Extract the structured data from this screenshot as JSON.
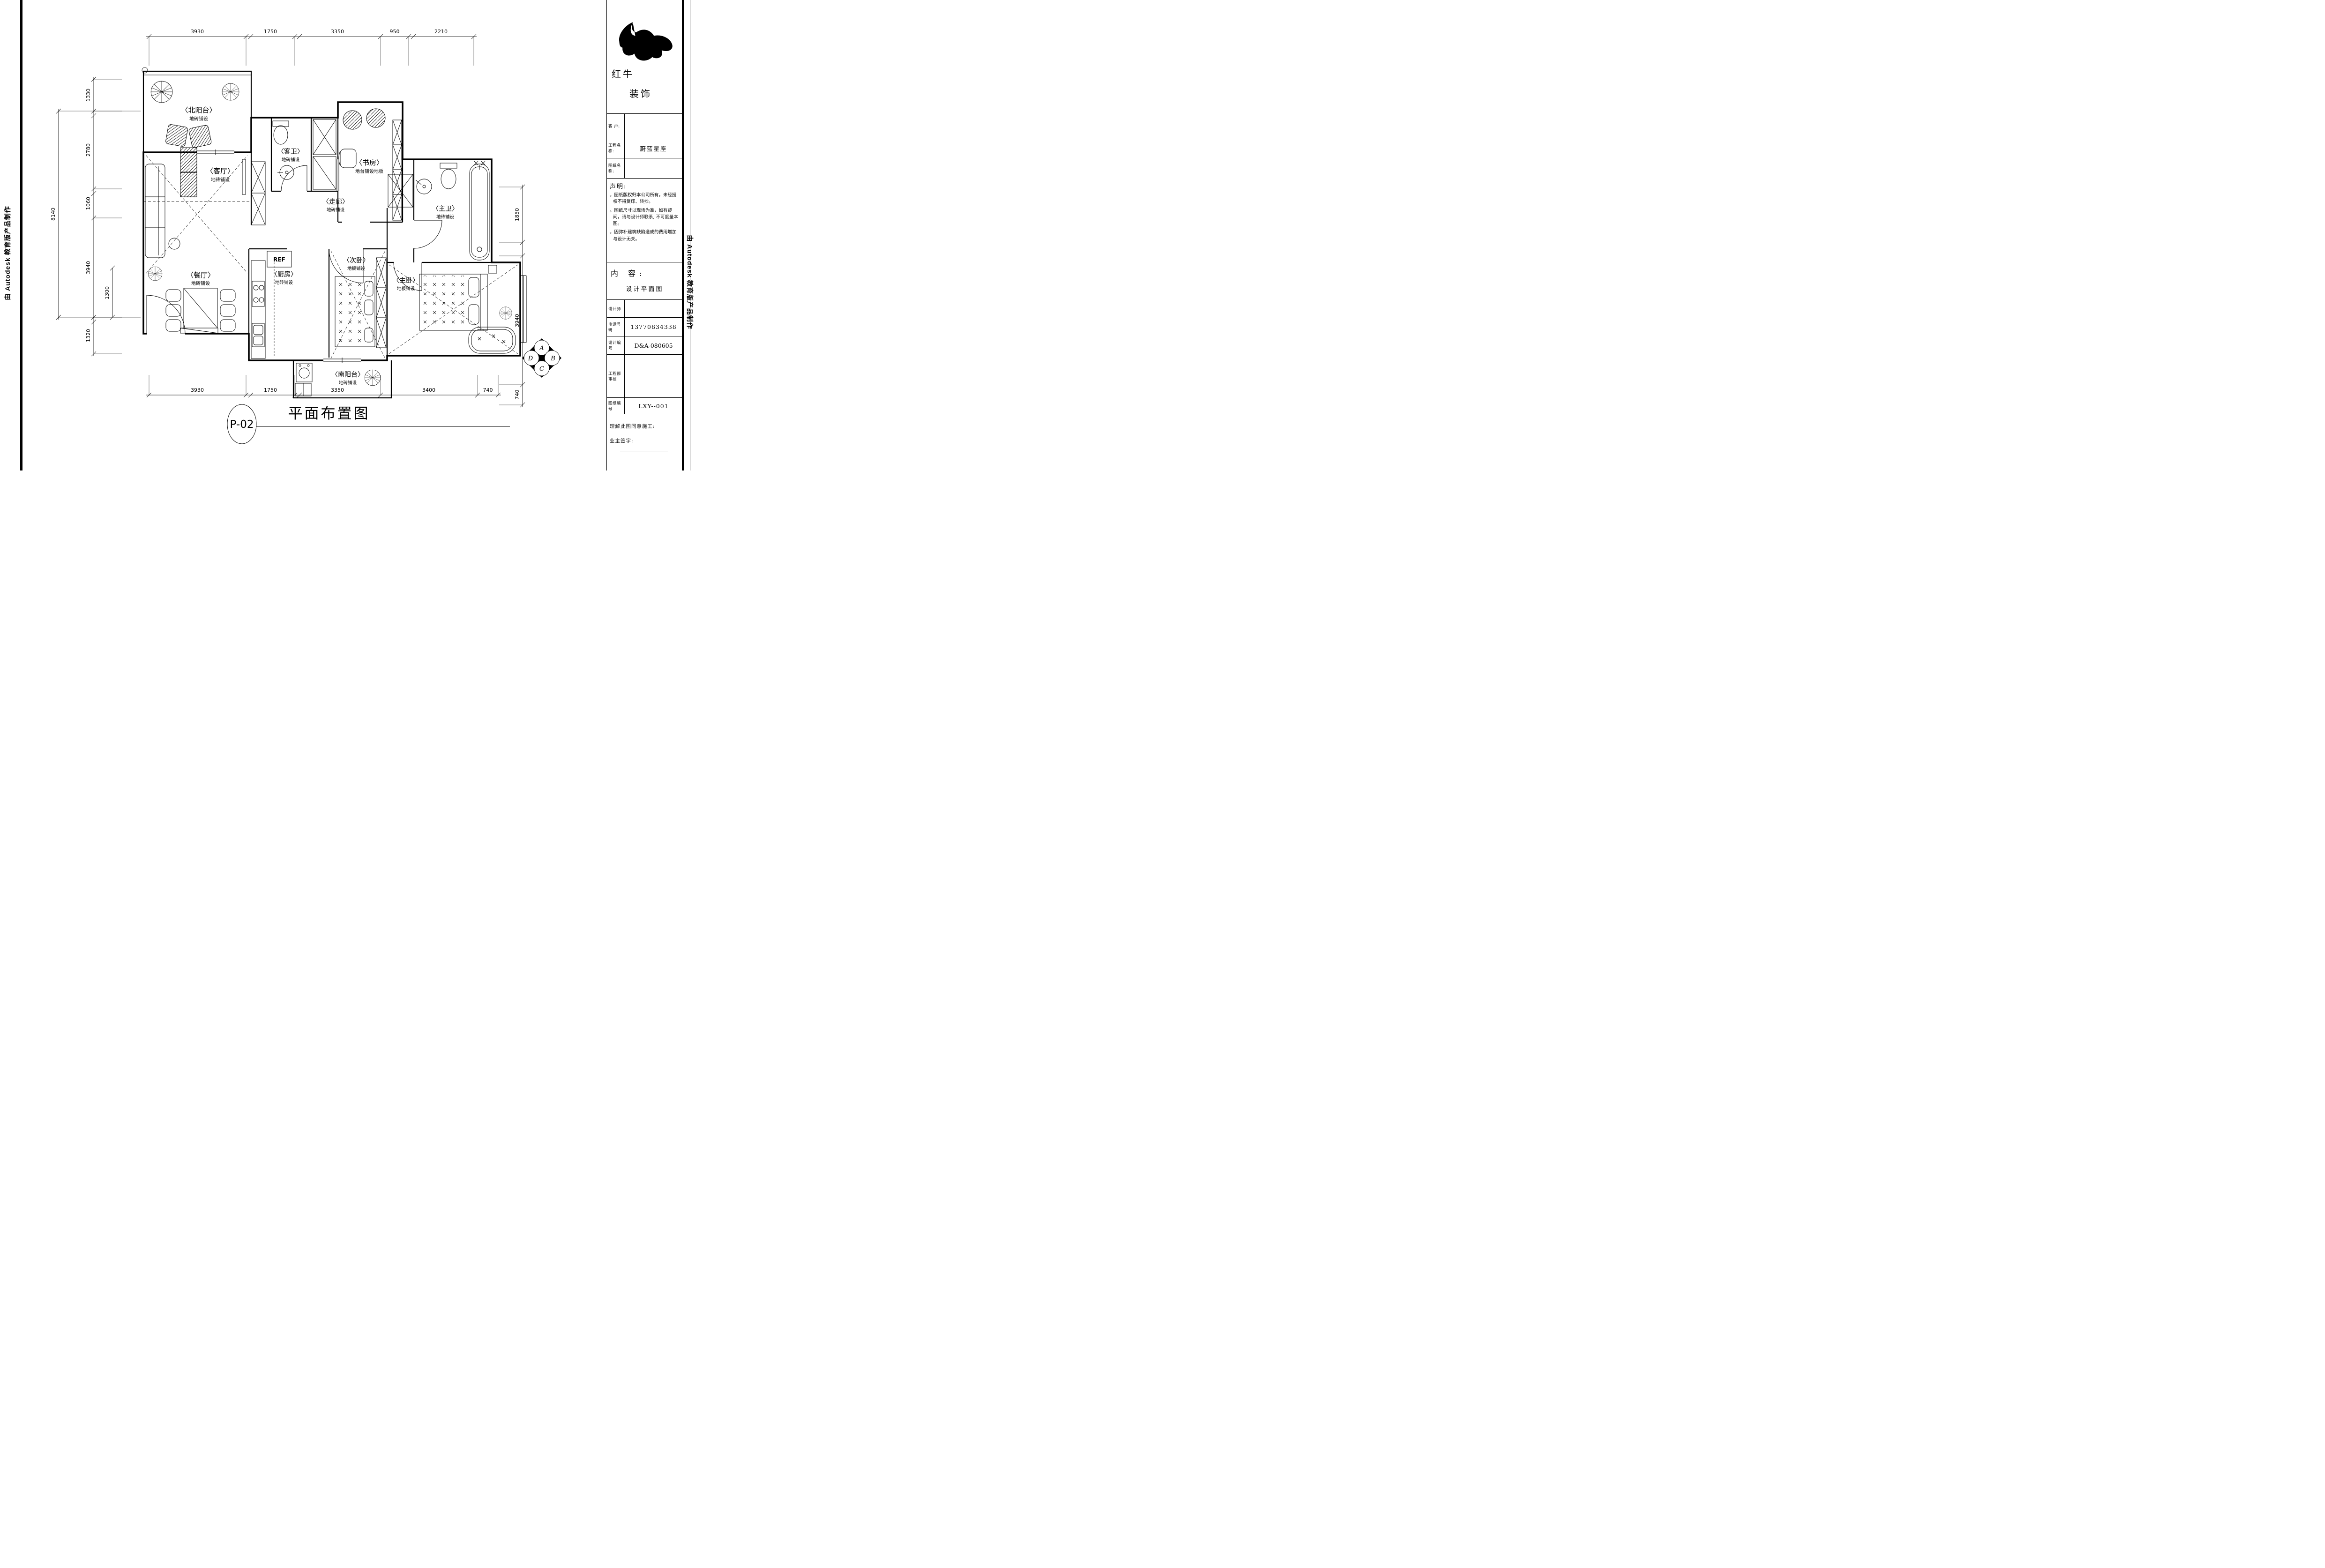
{
  "sidebars": {
    "left": "由 Autodesk 教育版产品制作",
    "right": "由 Autodesk 教育版产品制作"
  },
  "title_block": {
    "logo": {
      "line1": "红牛",
      "line2": "装饰"
    },
    "fields": {
      "client_label": "客  户:",
      "client_value": "",
      "project_label": "工程名称:",
      "project_value": "蔚蓝星座",
      "drawing_label": "图纸名称:",
      "drawing_value": ""
    },
    "statement": {
      "heading": "声明:",
      "items": [
        "。图纸版权归本公司所有，未经授权不得复印、转抄。",
        "。图纸尺寸以现场为准，如有疑问，请与设计师联系, 不可度量本图。",
        "。因弥补建筑缺陷造成的费用增加与设计无关。"
      ]
    },
    "content": {
      "heading": "内 容:",
      "value": "设计平面图"
    },
    "table": {
      "designer_label": "设计师",
      "designer_value": "",
      "phone_label": "电话号码",
      "phone_value": "13770834338",
      "design_no_label": "设计编号",
      "design_no_value": "D&A-080605",
      "review_label": "工程部审核",
      "review_value": "",
      "sheet_no_label": "图纸编号",
      "sheet_no_value": "LXY--001"
    },
    "footer": {
      "agree_label": "理解此图同意施工:",
      "sign_label": "业主签字:"
    }
  },
  "plan": {
    "rooms": [
      {
        "name": "〈北阳台〉",
        "finish": "地砖铺设"
      },
      {
        "name": "〈客厅〉",
        "finish": "地砖铺设"
      },
      {
        "name": "〈客卫〉",
        "finish": "地砖铺设"
      },
      {
        "name": "〈书房〉",
        "finish": "地台铺设地板"
      },
      {
        "name": "〈走廊〉",
        "finish": "地砖铺设"
      },
      {
        "name": "〈主卫〉",
        "finish": "地砖铺设"
      },
      {
        "name": "〈主卧〉",
        "finish": "地板铺设"
      },
      {
        "name": "〈次卧〉",
        "finish": "地板铺设"
      },
      {
        "name": "〈厨房〉",
        "finish": "地砖铺设"
      },
      {
        "name": "〈餐厅〉",
        "finish": "地砖铺设"
      },
      {
        "name": "〈南阳台〉",
        "finish": "地砖铺设"
      }
    ],
    "appliance_label": "REF",
    "compass": {
      "top": "A",
      "right": "B",
      "bottom": "C",
      "left": "D"
    }
  },
  "dimensions": {
    "top": [
      "3930",
      "1750",
      "3350",
      "950",
      "2210"
    ],
    "bottom": [
      "3930",
      "1750",
      "3350",
      "3400",
      "740"
    ],
    "left_outer": "8140",
    "left_inner": [
      "1330",
      "2780",
      "1060",
      "3940",
      "1320"
    ],
    "left_sub": "1300",
    "right": [
      "1850",
      "3940",
      "740"
    ]
  },
  "footer": {
    "number": "P-02",
    "title": "平面布置图"
  }
}
